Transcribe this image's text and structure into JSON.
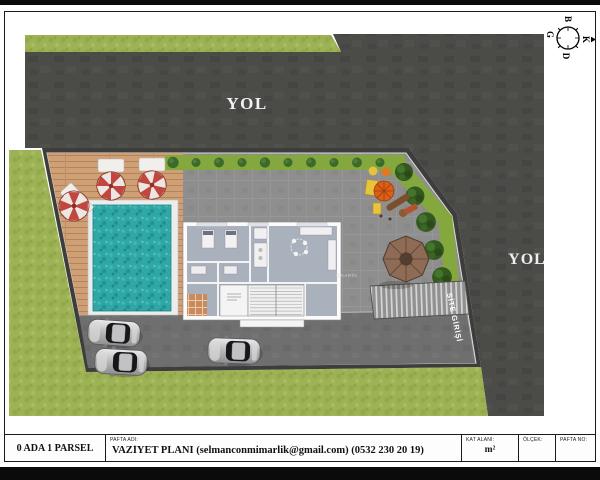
{
  "plan": {
    "road_top_label": "YOL",
    "road_right_label": "YOL",
    "entrance_label": "SİTE GİRİŞİ",
    "area_note": "Ç.KARTA"
  },
  "compass": {
    "north": "K",
    "south": "G",
    "east": "D",
    "west": "B"
  },
  "title_block": {
    "parcel": "0 ADA 1 PARSEL",
    "pafta_adi_label": "PAFTA ADI:",
    "pafta_adi_value": "VAZİYET PLANI (selmanconmimarlik@gmail.com) (0532 230 20 19)",
    "kat_alani_label": "KAT ALANI:",
    "kat_alani_value": "m²",
    "olcek_label": "ÖLÇEK:",
    "olcek_value": "",
    "pafta_no_label": "PAFTA NO:",
    "pafta_no_value": ""
  },
  "colors": {
    "road": "#4b4b48",
    "grass": "#9cb254",
    "pavement": "#8e8e8e",
    "parking": "#6e6e6e",
    "deck_wood": "#cf9f76",
    "pool_water": "#2ea7a6",
    "umbrella_red": "#c14540",
    "hedge_green": "#84a73e",
    "gazebo_brown": "#8d6b55"
  }
}
